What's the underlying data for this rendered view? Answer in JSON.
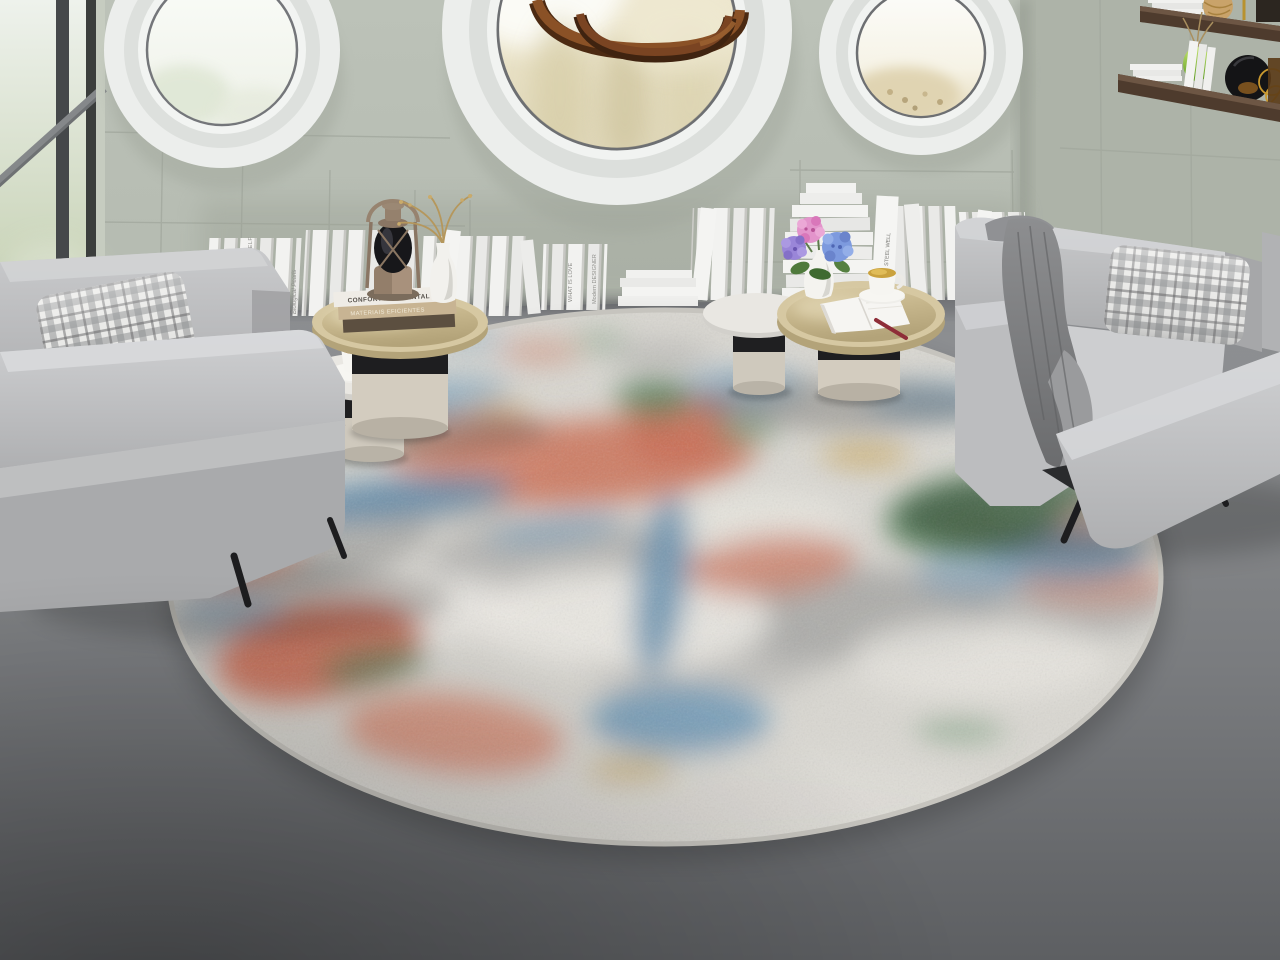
{
  "scene": {
    "description": "Bright modern lounge with three round porthole windows, a spiral wooden ring pendant, rows of white books leaning along the wall, two grey fabric armchairs on the left, two on the right with a grey throw, nesting champagne-brass coffee tables with a vintage lantern, hydrangea vase and coffee cups, all on a large round abstract distressed rug over a grey concrete floor",
    "style": "interior 3d render"
  },
  "palette": {
    "wall": "#b3b9af",
    "floor": "#7e8083",
    "rug_base": "#dad8d2",
    "rug_coral": "#cd7a61",
    "rug_blue": "#6f9ab8",
    "rug_green": "#4f7a55",
    "rug_mustard": "#c7a14e",
    "chair_grey": "#b8b9bb",
    "brass": "#c9b98e",
    "shelf_wood": "#4e3b2d",
    "pendant_wood": "#7a4422"
  },
  "coffee_table_books": {
    "top": "CONFORTO AMBIENTAL",
    "middle": "MATERIAIS EFICIENTES"
  },
  "floor_book_spines": {
    "left_a": "FATALISM OF YOURSELF",
    "left_b": "Biological Pearls",
    "center_a": "WHAT IS LOVE",
    "center_b": "Modern DESIGNER",
    "right_a": "STEEL WELL"
  }
}
